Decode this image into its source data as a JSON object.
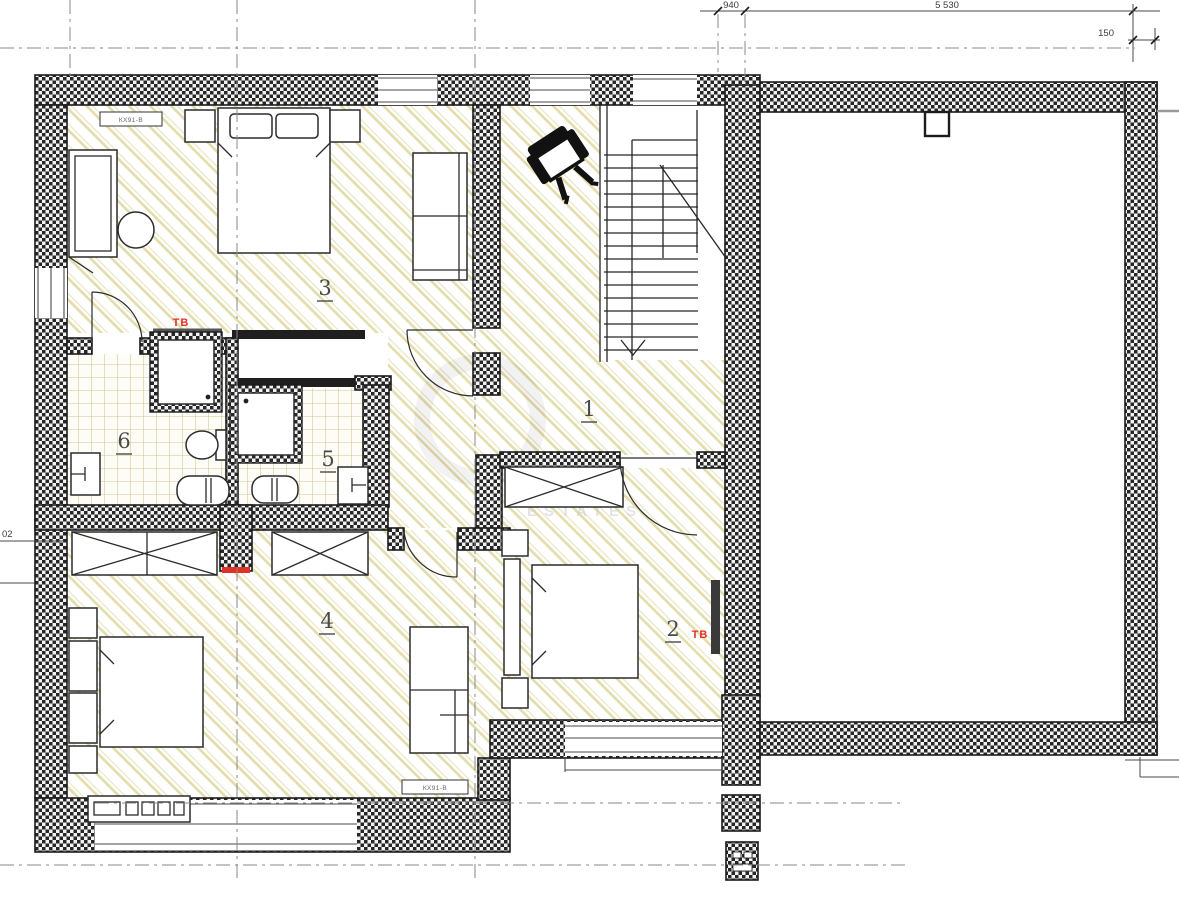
{
  "colors": {
    "wall_fill": "#262626",
    "line": "#1c1c1c",
    "floor_hatch": "#d9d08f",
    "tile_line": "#cfc68c",
    "accent_red": "#e03226",
    "grid_line": "#8a8a8a",
    "dim_text": "#3a3a3a",
    "label": "#4a4a4a",
    "watermark": "#c9c9c9"
  },
  "rooms": [
    {
      "id": "hall-stairs",
      "label": "1"
    },
    {
      "id": "bedroom-right",
      "label": "2"
    },
    {
      "id": "bedroom-top-left",
      "label": "3"
    },
    {
      "id": "bedroom-bottom-left",
      "label": "4"
    },
    {
      "id": "bathroom-inner",
      "label": "5"
    },
    {
      "id": "bathroom-outer",
      "label": "6"
    }
  ],
  "annotations": {
    "tv_room3": "ТВ",
    "tv_room2": "ТВ"
  },
  "dimensions": {
    "top_small": "940",
    "top_main": "5 530",
    "top_right": "150",
    "left_partial": "02"
  },
  "equipment_tags": {
    "room3_top": "КХ91-В",
    "room4_bottom": "КХ91-В"
  },
  "watermark": {
    "text": "ESTATES"
  }
}
